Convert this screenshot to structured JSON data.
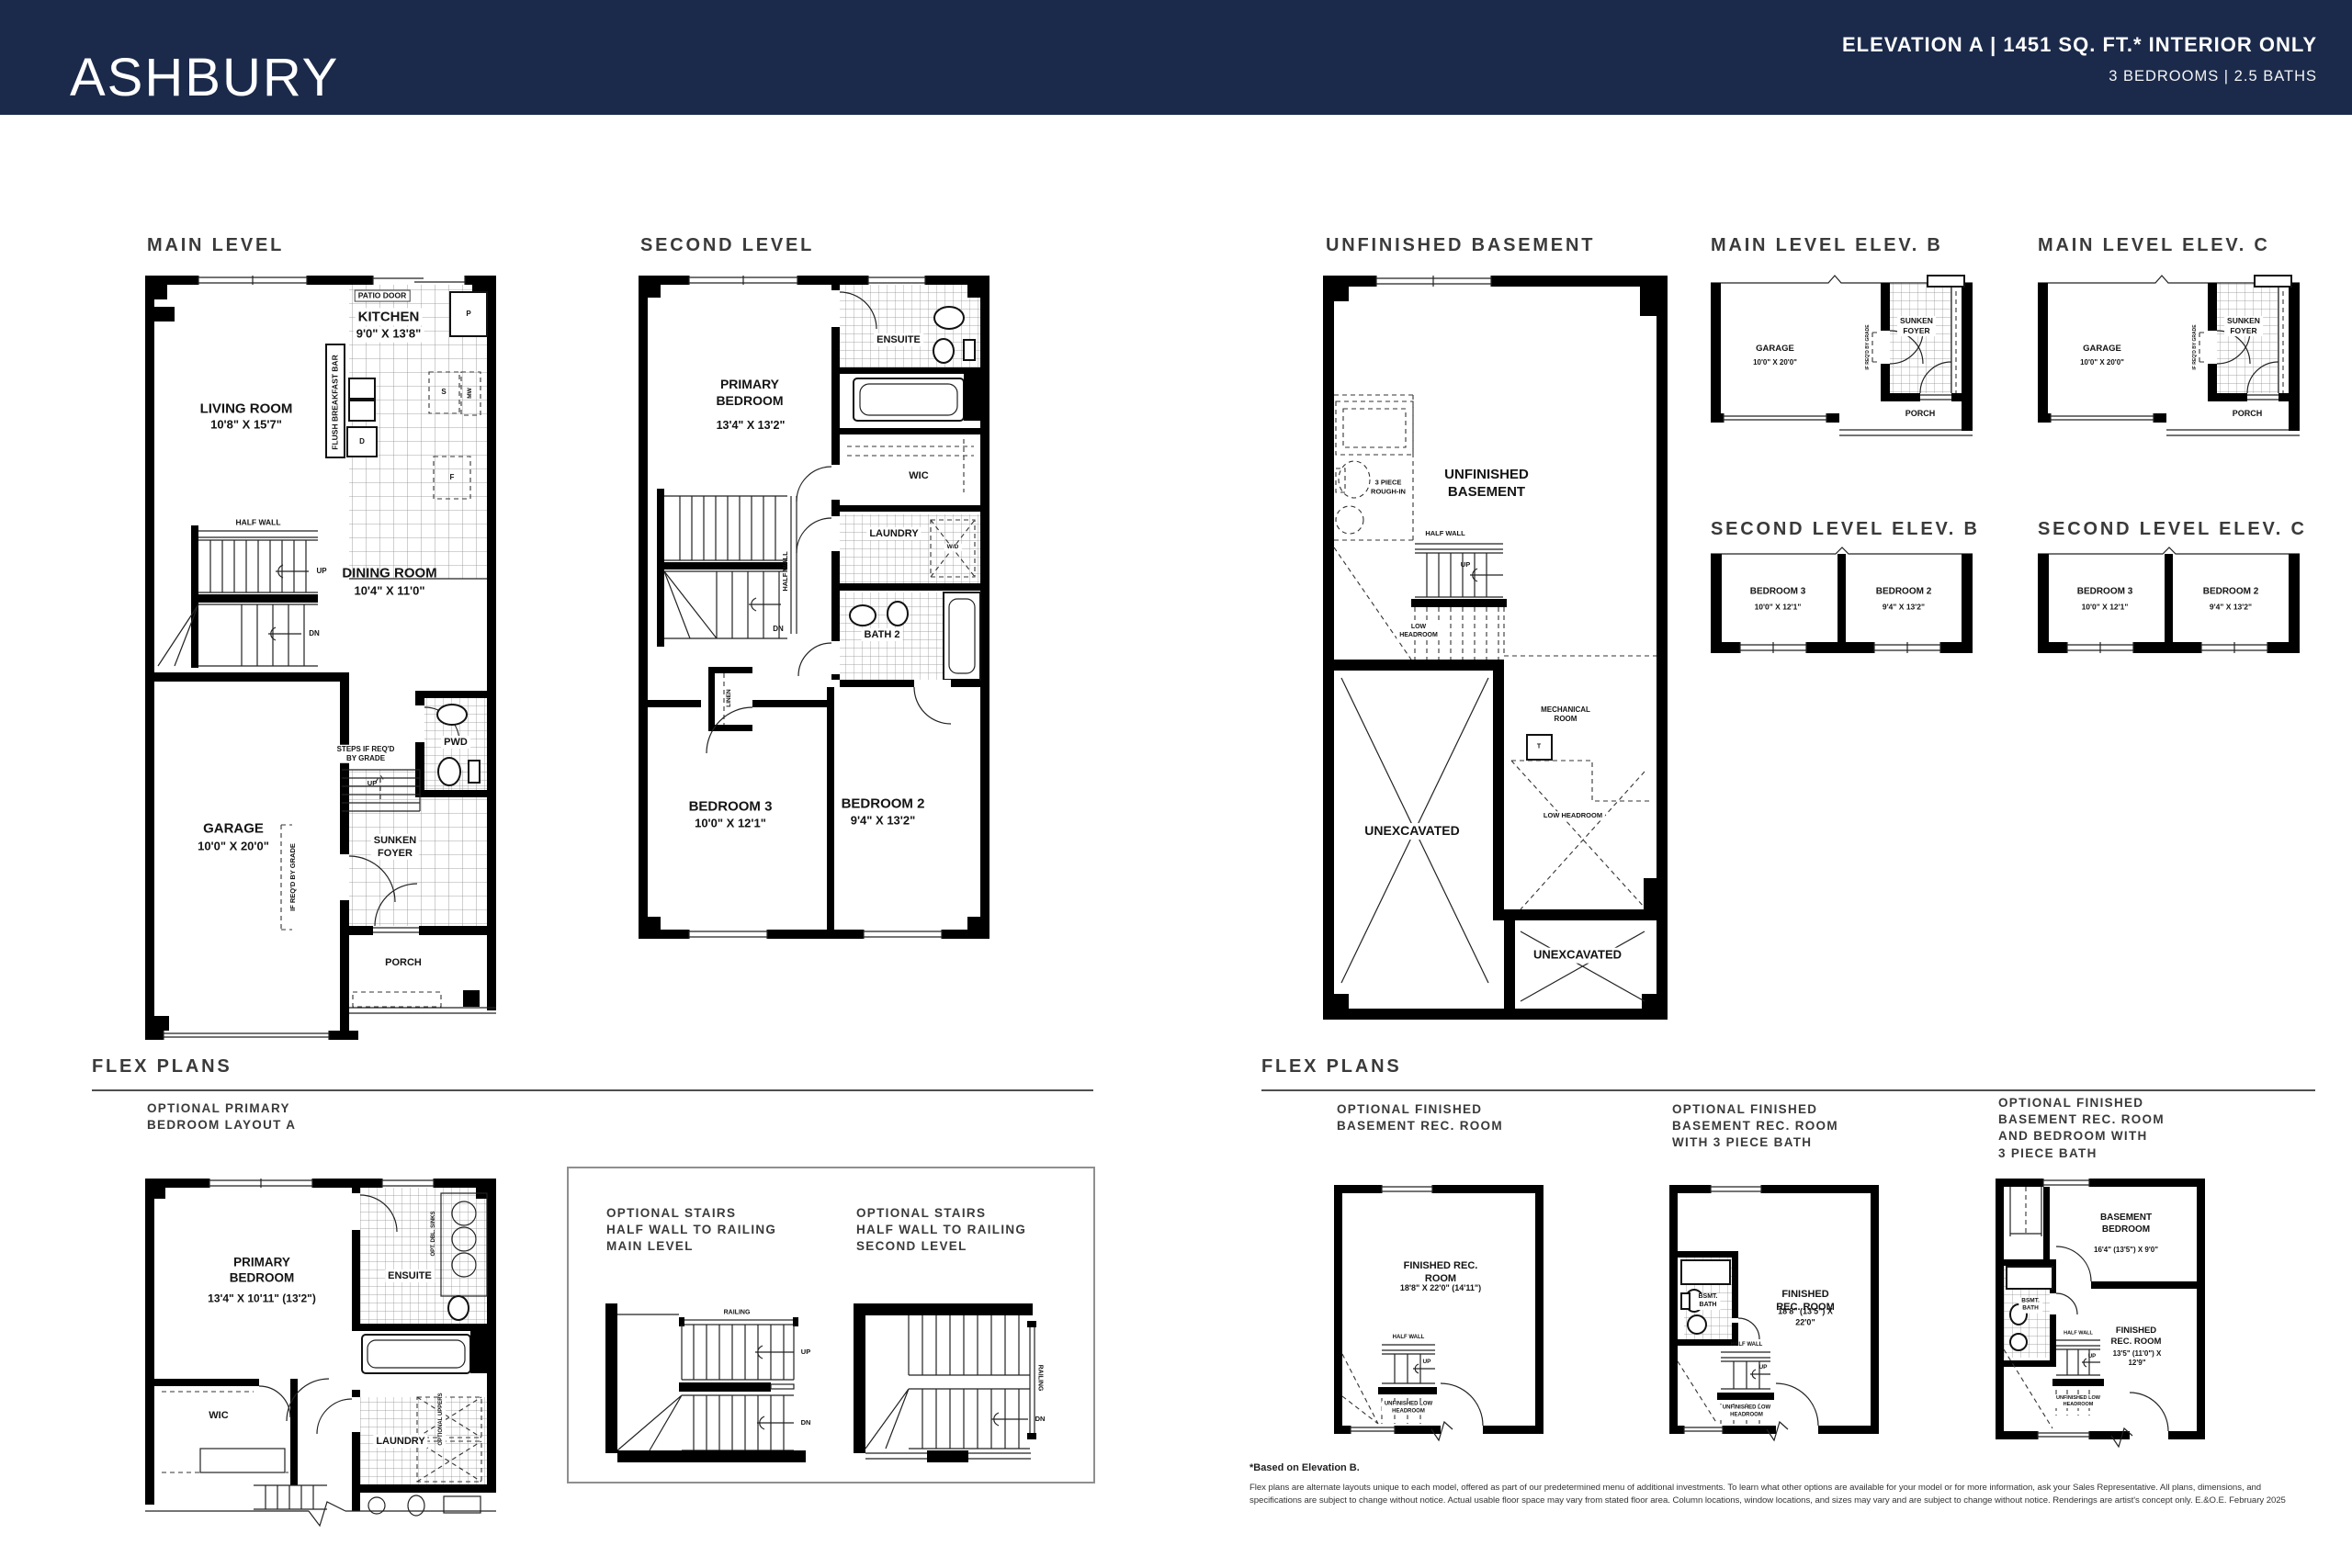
{
  "header": {
    "title": "ASHBURY",
    "elevation_line": "ELEVATION A  |  1451 SQ. FT.* INTERIOR ONLY",
    "bed_bath_line": "3 BEDROOMS  |  2.5 BATHS"
  },
  "colors": {
    "header_bg": "#1b2a4a",
    "wall": "#000000",
    "heading_text": "#3a3a3a"
  },
  "sections": {
    "main_level": "MAIN LEVEL",
    "second_level": "SECOND LEVEL",
    "unfinished_basement": "UNFINISHED BASEMENT",
    "main_level_elev_b": "MAIN LEVEL ELEV. B",
    "main_level_elev_c": "MAIN LEVEL ELEV. C",
    "second_level_elev_b": "SECOND LEVEL ELEV. B",
    "second_level_elev_c": "SECOND LEVEL ELEV. C",
    "flex_plans_left": "FLEX PLANS",
    "flex_plans_right": "FLEX PLANS"
  },
  "main_level": {
    "patio_door": "PATIO DOOR",
    "kitchen_name": "KITCHEN",
    "kitchen_dims": "9'0\" X 13'8\"",
    "living_name": "LIVING ROOM",
    "living_dims": "10'8\" X 15'7\"",
    "flush_bar": "FLUSH BREAKFAST BAR",
    "half_wall": "HALF WALL",
    "up": "UP",
    "dn": "DN",
    "dining_name": "DINING ROOM",
    "dining_dims": "10'4\" X 11'0\"",
    "garage_name": "GARAGE",
    "garage_dims": "10'0\" X 20'0\"",
    "steps_note": "STEPS IF REQ'D\nBY GRADE",
    "up2": "UP",
    "pwd": "PWD",
    "sunken_foyer": "SUNKEN\nFOYER",
    "grade_note": "IF REQ'D BY GRADE",
    "porch": "PORCH",
    "appl_p": "P",
    "appl_s": "S",
    "appl_mw": "MW",
    "appl_d": "D",
    "appl_f": "F"
  },
  "second_level": {
    "primary_name": "PRIMARY\nBEDROOM",
    "primary_dims": "13'4\" X 13'2\"",
    "ensuite": "ENSUITE",
    "wic": "WIC",
    "laundry": "LAUNDRY",
    "wd": "W/D",
    "half_wall": "HALF WALL",
    "dn": "DN",
    "bath2": "BATH 2",
    "linen": "LINEN",
    "bed3_name": "BEDROOM 3",
    "bed3_dims": "10'0\" X 12'1\"",
    "bed2_name": "BEDROOM 2",
    "bed2_dims": "9'4\" X 13'2\""
  },
  "basement": {
    "rough_in": "3 PIECE\nROUGH-IN",
    "room_name": "UNFINISHED\nBASEMENT",
    "half_wall": "HALF WALL",
    "up": "UP",
    "low_headroom_stairs": "LOW\nHEADROOM",
    "mechanical": "MECHANICAL\nROOM",
    "t": "T",
    "low_headroom": "LOW HEADROOM",
    "unexcavated_left": "UNEXCAVATED",
    "unexcavated_bottom": "UNEXCAVATED"
  },
  "elev_main": {
    "garage_name": "GARAGE",
    "garage_dims": "10'0\" X 20'0\"",
    "sunken_foyer": "SUNKEN\nFOYER",
    "porch": "PORCH",
    "grade_note": "IF REQ'D BY GRADE"
  },
  "elev_second": {
    "bed3_name": "BEDROOM 3",
    "bed3_dims": "10'0\" X 12'1\"",
    "bed2_name": "BEDROOM 2",
    "bed2_dims": "9'4\" X 13'2\""
  },
  "flex_left": {
    "heading": "OPTIONAL PRIMARY\nBEDROOM LAYOUT A",
    "primary_name": "PRIMARY\nBEDROOM",
    "primary_dims": "13'4\" X 10'11\" (13'2\")",
    "ensuite": "ENSUITE",
    "opt_dbl_sinks": "OPT. DBL. SINKS",
    "wic": "WIC",
    "laundry": "LAUNDRY",
    "optional_uppers": "OPTIONAL UPPERS"
  },
  "flex_stairs": {
    "heading_main": "OPTIONAL STAIRS\nHALF WALL TO RAILING\nMAIN LEVEL",
    "heading_second": "OPTIONAL STAIRS\nHALF WALL TO RAILING\nSECOND LEVEL",
    "railing": "RAILING",
    "up": "UP",
    "dn": "DN"
  },
  "flex_right": {
    "plan1_heading": "OPTIONAL FINISHED\nBASEMENT REC. ROOM",
    "plan1_room_name": "FINISHED REC. ROOM",
    "plan1_room_dims": "18'8\" X 22'0\" (14'11\")",
    "plan2_heading": "OPTIONAL FINISHED\nBASEMENT REC. ROOM\nWITH 3 PIECE BATH",
    "plan2_room_name": "FINISHED REC. ROOM",
    "plan2_room_dims": "18'8\" (13'5\") X 22'0\"",
    "plan3_heading": "OPTIONAL FINISHED\nBASEMENT REC. ROOM\nAND BEDROOM WITH\n3 PIECE BATH",
    "plan3_bed_name": "BASEMENT\nBEDROOM",
    "plan3_bed_dims": "16'4\" (13'5\") X 9'0\"",
    "plan3_room_name": "FINISHED\nREC. ROOM",
    "plan3_room_dims": "13'5\" (11'0\") X 12'9\"",
    "bsmt_bath": "BSMT.\nBATH",
    "half_wall": "HALF WALL",
    "up": "UP",
    "low_headroom": "UNFINISHED LOW\nHEADROOM"
  },
  "footer": {
    "note": "*Based on Elevation B.",
    "disclaimer_line1": "Flex plans are alternate layouts unique to each model, offered as part of our predetermined menu of additional investments. To learn what other options are available for your model or for more information, ask your Sales Representative. All plans, dimensions, and",
    "disclaimer_line2": "specifications are subject to change without notice. Actual usable floor space may vary from stated floor area. Column locations, window locations, and sizes may vary and are subject to change without notice. Renderings are artist's concept only. E.&O.E. February 2025"
  }
}
